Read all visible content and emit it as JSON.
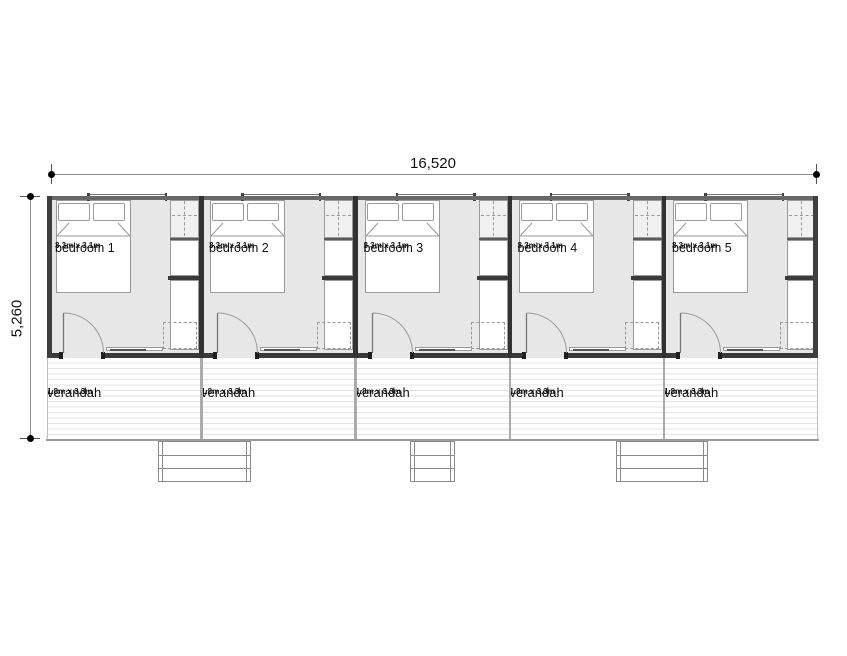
{
  "dimensions": {
    "overall_width": "16,520",
    "overall_depth": "5,260"
  },
  "units": [
    {
      "bedroom_label": "bedroom 1",
      "bedroom_size": "3.3m x 3.1m",
      "verandah_label": "verandah",
      "verandah_size": "1.8m x 3.3m"
    },
    {
      "bedroom_label": "bedroom 2",
      "bedroom_size": "3.3m x 3.1m",
      "verandah_label": "verandah",
      "verandah_size": "1.8m x 3.3m"
    },
    {
      "bedroom_label": "bedroom 3",
      "bedroom_size": "3.3m x 3.1m",
      "verandah_label": "verandah",
      "verandah_size": "1.8m x 3.3m"
    },
    {
      "bedroom_label": "bedroom 4",
      "bedroom_size": "3.3m x 3.1m",
      "verandah_label": "verandah",
      "verandah_size": "1.8m x 3.3m"
    },
    {
      "bedroom_label": "bedroom 5",
      "bedroom_size": "3.3m x 3.1m",
      "verandah_label": "verandah",
      "verandah_size": "1.8m x 3.3m"
    }
  ],
  "colors": {
    "wall": "#3a3a3a",
    "floor": "#e7e7e7",
    "furniture_outline": "#9a9a9a",
    "deck_divider": "#ababab",
    "dimension_line": "#8a8a8a"
  }
}
